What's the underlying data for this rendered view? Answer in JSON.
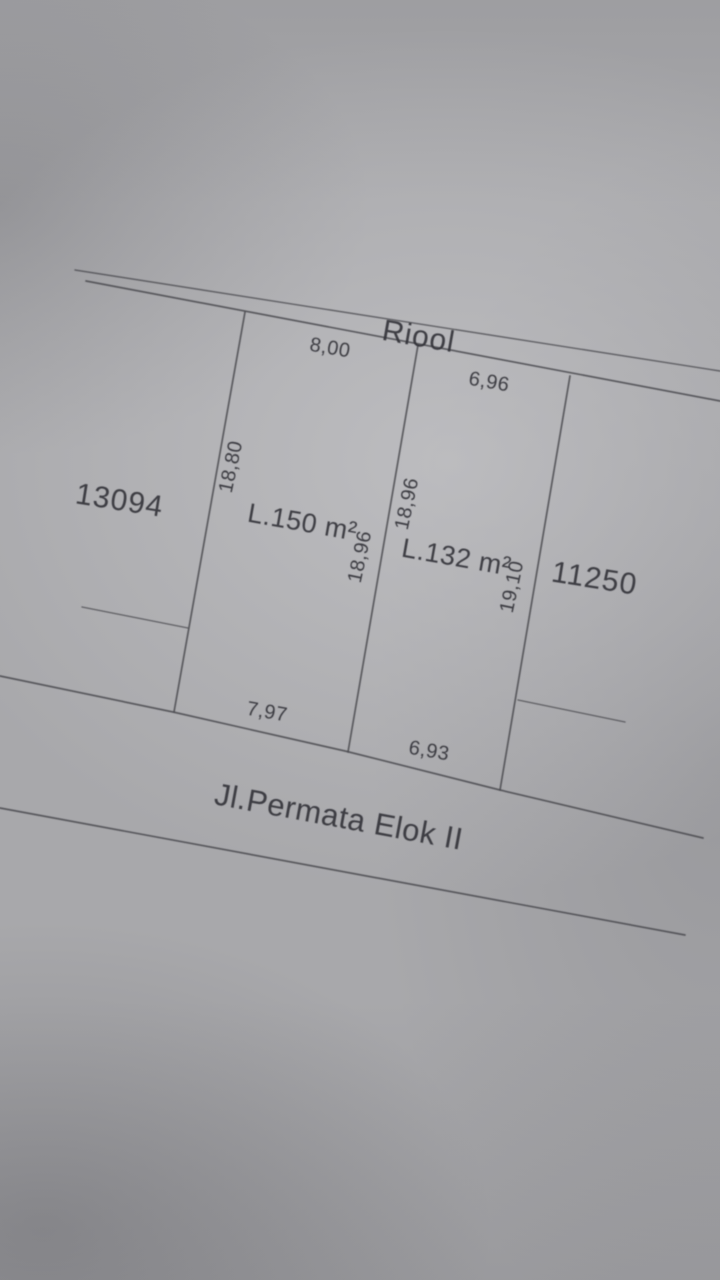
{
  "photo": {
    "paper_base_color": "#a8a8ab",
    "line_color": "#4d4d53",
    "ink_color": "#34343a"
  },
  "diagram": {
    "canal_label": "Riool",
    "street_label": "Jl.Permata Elok II",
    "left_lot_number": "13094",
    "right_lot_number": "11250",
    "parcels": [
      {
        "area": "L.150 m²",
        "width_top": "8,00",
        "width_bottom": "7,97",
        "depth_left": "18,80",
        "depth_right": "18,96"
      },
      {
        "area": "L.132 m²",
        "width_top": "6,96",
        "width_bottom": "6,93",
        "depth_left": "18,96",
        "depth_right": "19,10"
      }
    ]
  }
}
